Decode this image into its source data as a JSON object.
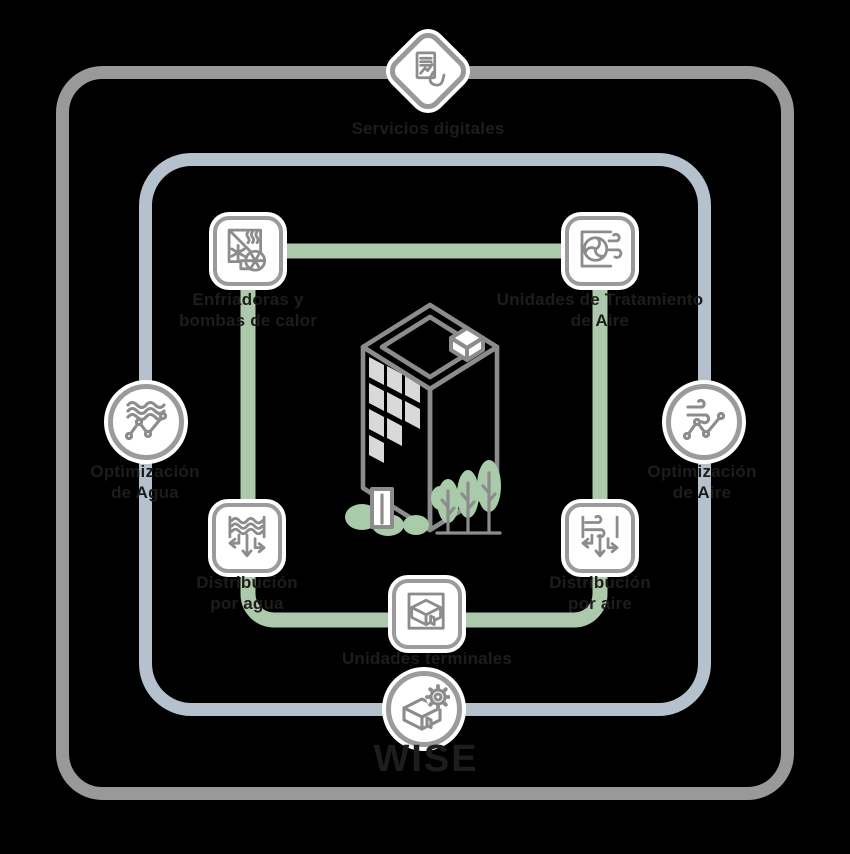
{
  "title": "WISE",
  "colors": {
    "background": "#000000",
    "outer_frame": "#999999",
    "inner_frame": "#b5c1cc",
    "hvac_loop_green": "#adc9ab",
    "icon_border": "#9b9b9b",
    "icon_stroke": "#8c8c8c",
    "label_text": "#1d1d1b",
    "building_window": "#d9d9d9",
    "foliage_green": "#a9cba9"
  },
  "nodes": {
    "digital_services": {
      "label": "Servicios digitales",
      "icon": "document-hand-icon"
    },
    "chillers": {
      "label_line1": "Enfriadoras y",
      "label_line2": "bombas de calor",
      "icon": "chiller-heatpump-icon"
    },
    "air_handling": {
      "label_line1": "Unidades de Tratamiento",
      "label_line2": "de Aire",
      "icon": "air-handling-unit-icon"
    },
    "water_distribution": {
      "label_line1": "Distribución",
      "label_line2": "por agua",
      "icon": "water-distribution-icon"
    },
    "air_distribution": {
      "label_line1": "Distribución",
      "label_line2": "por aire",
      "icon": "air-distribution-icon"
    },
    "terminal_units": {
      "label": "Unidades terminales",
      "icon": "terminal-unit-icon"
    },
    "water_optimization": {
      "label_line1": "Optimización",
      "label_line2": "de Agua",
      "icon": "water-optimization-icon"
    },
    "air_optimization": {
      "label_line1": "Optimización",
      "label_line2": "de Aire",
      "icon": "air-optimization-icon"
    },
    "wise": {
      "label": "WISE",
      "icon": "wise-room-gear-icon"
    }
  }
}
